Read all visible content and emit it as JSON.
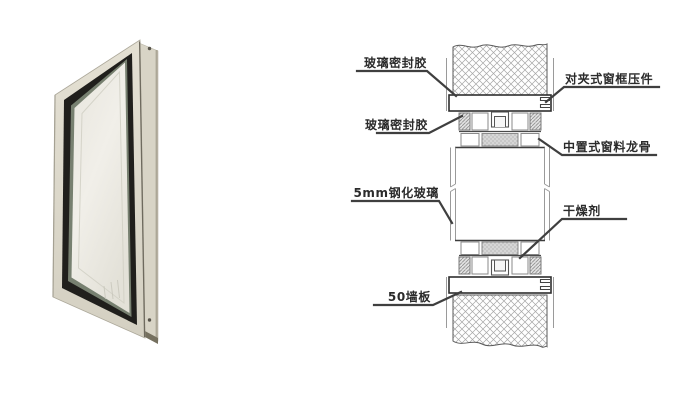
{
  "figure": {
    "type": "window-section-detail",
    "photo": {
      "colors": {
        "frame_cream": "#d9d5c7",
        "gasket_black": "#201f1c",
        "glass_light": "#eeece5",
        "glass_edge_olive": "#778070",
        "flange_shadow": "#75705f"
      }
    },
    "diagram": {
      "labels": {
        "glass_sealant_top": "玻璃密封胶",
        "clamp_press": "对夹式窗框压件",
        "glass_sealant_mid": "玻璃密封胶",
        "center_keel": "中置式窗料龙骨",
        "tempered_glass": "5mm钢化玻璃",
        "desiccant": "干燥剂",
        "wall_panel": "50墙板"
      },
      "colors": {
        "leader_line": "#3f3f3f",
        "label_text": "#2b2b2b",
        "hatch_line": "#a0a0a0"
      }
    }
  }
}
